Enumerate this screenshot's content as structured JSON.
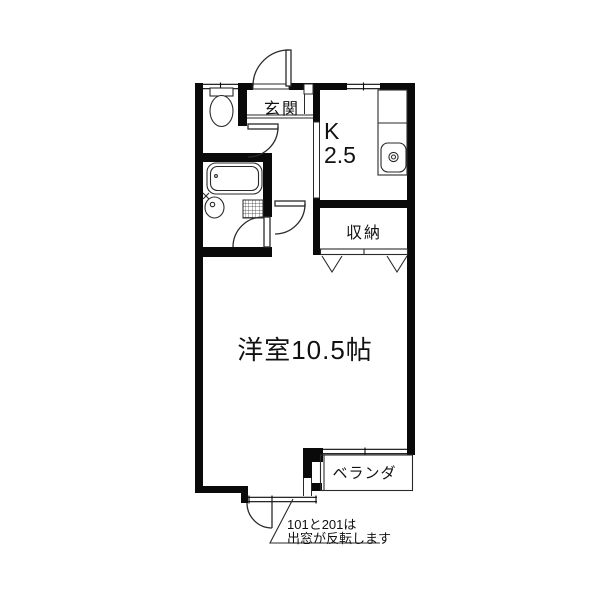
{
  "floor_plan": {
    "background": "#ffffff",
    "wall_color": "#0a0a0a",
    "line_color": "#2a2a2a",
    "rooms": {
      "genkan": {
        "label": "玄関"
      },
      "kitchen": {
        "label": "K",
        "size": "2.5"
      },
      "storage": {
        "label": "収納"
      },
      "main_room": {
        "label": "洋室10.5帖"
      },
      "veranda": {
        "label": "ベランダ"
      }
    },
    "note": {
      "line1": "101と201は",
      "line2": "出窓が反転します"
    },
    "fixtures": {
      "toilet": "toilet-icon",
      "bathtub": "bathtub-icon",
      "washbasin": "washbasin-icon",
      "washing_machine_pan": "washing-machine-pan-icon",
      "kitchen_sink": "kitchen-sink-icon",
      "closet_doors": "closet-doors-icon",
      "bay_window": "bay-window-icon"
    }
  }
}
